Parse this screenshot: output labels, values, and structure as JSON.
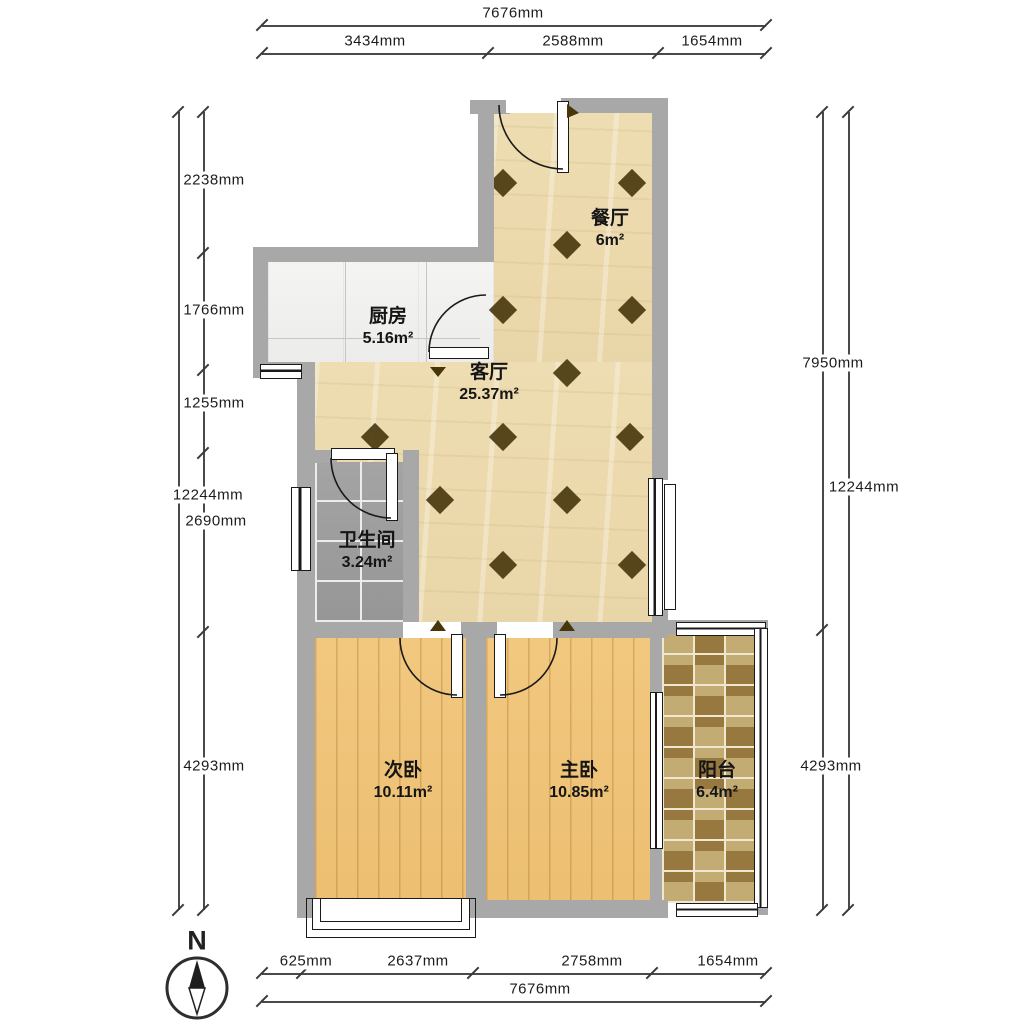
{
  "compass": {
    "label": "N"
  },
  "dimensions": {
    "top": {
      "overall": "7676mm",
      "segments": [
        "3434mm",
        "2588mm",
        "1654mm"
      ]
    },
    "bottom": {
      "overall": "7676mm",
      "segments": [
        "625mm",
        "2637mm",
        "2758mm",
        "1654mm"
      ]
    },
    "left": {
      "overall": "12244mm",
      "segments": [
        "2238mm",
        "1766mm",
        "1255mm",
        "2690mm",
        "4293mm"
      ]
    },
    "right": {
      "overall": "12244mm",
      "segments": [
        "7950mm",
        "4293mm"
      ]
    }
  },
  "rooms": [
    {
      "name": "餐厅",
      "area": "6m²"
    },
    {
      "name": "厨房",
      "area": "5.16m²"
    },
    {
      "name": "客厅",
      "area": "25.37m²"
    },
    {
      "name": "卫生间",
      "area": "3.24m²"
    },
    {
      "name": "次卧",
      "area": "10.11m²"
    },
    {
      "name": "主卧",
      "area": "10.85m²"
    },
    {
      "name": "阳台",
      "area": "6.4m²"
    }
  ],
  "colors": {
    "wall": "#a8a8a8",
    "floor_main": "#ecdcb2",
    "floor_wood": "#f0c47c",
    "floor_bath": "#9f9f9f",
    "balcony_tile_dark": "#97793f",
    "balcony_tile_light": "#c3ab74",
    "diamond_decor": "#4a390f"
  }
}
